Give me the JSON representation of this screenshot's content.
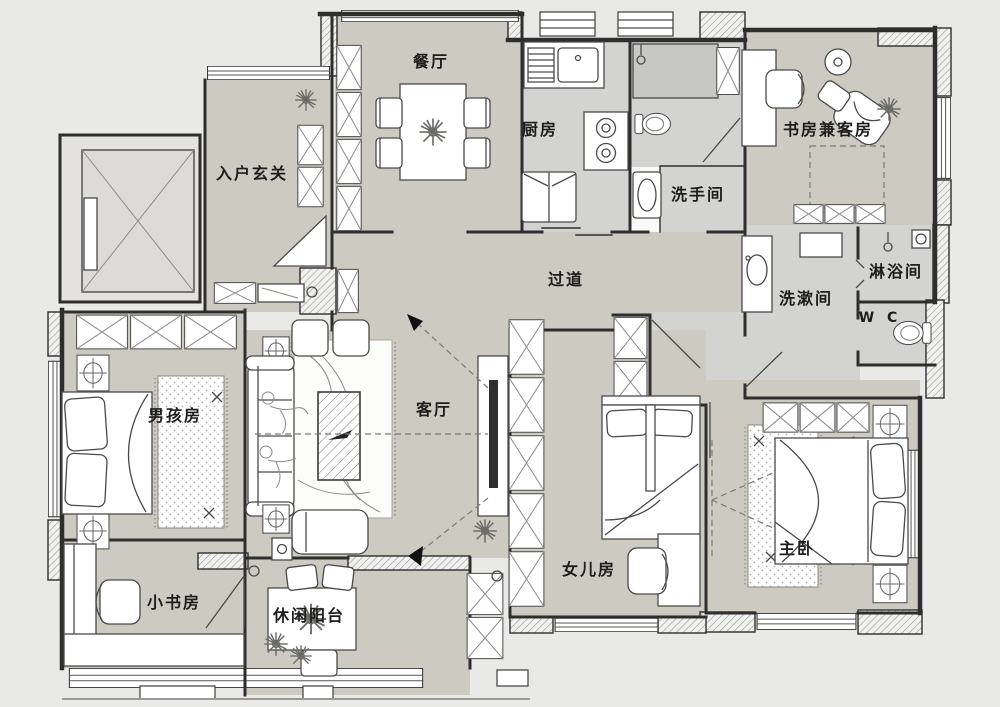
{
  "colors": {
    "background": "#e9e9e7",
    "floor": "#cdcac1",
    "wet_floor": "#d3d3d2",
    "shower_box": "#c7c7c5",
    "wall": "#2e2e2e",
    "furniture_stroke": "#4a4a4a",
    "label_color": "#1d1d1d"
  },
  "rooms": [
    {
      "id": "dining",
      "label": "餐厅"
    },
    {
      "id": "entry",
      "label": "入户玄关"
    },
    {
      "id": "kitchen",
      "label": "厨房"
    },
    {
      "id": "study-guest",
      "label": "书房兼客房"
    },
    {
      "id": "washroom",
      "label": "洗手间"
    },
    {
      "id": "hallway",
      "label": "过道"
    },
    {
      "id": "wash-area",
      "label": "洗漱间"
    },
    {
      "id": "shower-room",
      "label": "淋浴间"
    },
    {
      "id": "wc",
      "label": "W C"
    },
    {
      "id": "boys-room",
      "label": "男孩房"
    },
    {
      "id": "living-room",
      "label": "客厅"
    },
    {
      "id": "master",
      "label": "主卧"
    },
    {
      "id": "daughter",
      "label": "女儿房"
    },
    {
      "id": "small-study",
      "label": "小书房"
    },
    {
      "id": "balcony",
      "label": "休闲阳台"
    }
  ]
}
